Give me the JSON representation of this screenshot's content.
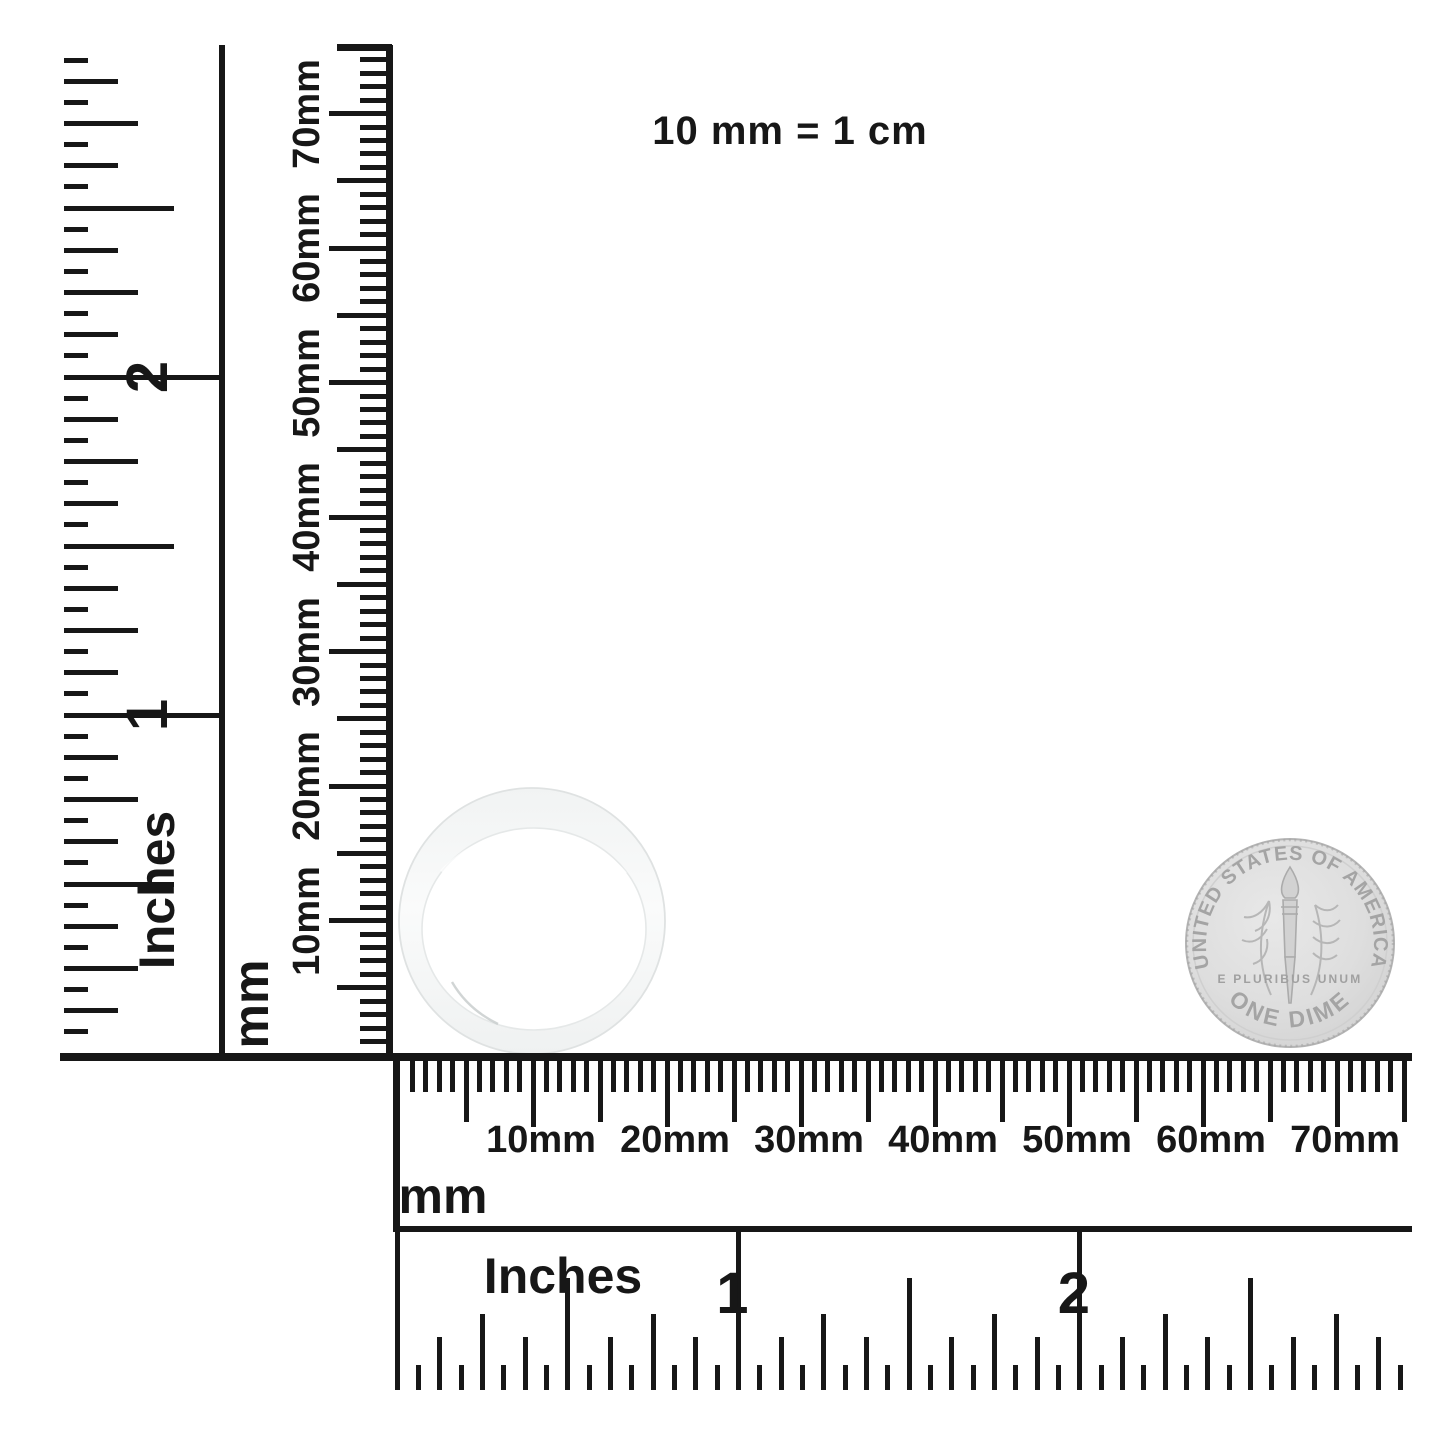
{
  "caption": "10 mm = 1 cm",
  "vertical_inch_ruler": {
    "unit": "Inches",
    "numbers": [
      "1",
      "2"
    ]
  },
  "vertical_mm_ruler": {
    "unit": "mm",
    "labels": [
      "10mm",
      "20mm",
      "30mm",
      "40mm",
      "50mm",
      "60mm",
      "70mm"
    ]
  },
  "horizontal_mm_ruler": {
    "unit": "mm",
    "labels": [
      "10mm",
      "20mm",
      "30mm",
      "40mm",
      "50mm",
      "60mm",
      "70mm"
    ]
  },
  "horizontal_inch_ruler": {
    "unit": "Inches",
    "numbers": [
      "1",
      "2"
    ]
  },
  "coin": {
    "legend_top": "UNITED STATES OF AMERICA",
    "legend_bottom": "ONE DIME",
    "motto": "E PLURIBUS UNUM"
  },
  "colors": {
    "ink": "#171717",
    "coin_face": "#dedede",
    "coin_rim": "#b4b4b4",
    "coin_text": "#a4a4a4",
    "ring_fill": "#f4f5f5",
    "ring_edge": "#dfe2e2"
  }
}
